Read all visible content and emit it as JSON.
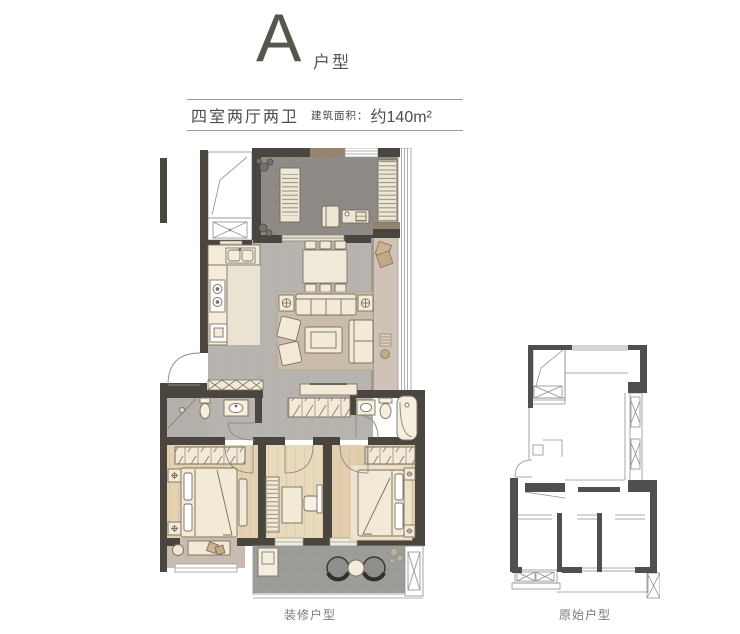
{
  "header": {
    "type_letter": "A",
    "type_suffix": "户型"
  },
  "spec": {
    "rooms": "四室两厅两卫",
    "area_label": "建筑面积：",
    "area_value": "约140m²"
  },
  "captions": {
    "furnished": "装修户型",
    "original": "原始户型"
  },
  "colors": {
    "title_gray": "#58554f",
    "label_gray": "#7a7a7a",
    "wall_dark": "#4a453f",
    "wall_brown_accent": "#94836f",
    "floor_main_gray": "#b7b4b0",
    "floor_dark_room": "#8e8b86",
    "floor_kitchen_cream": "#ebe3d1",
    "floor_wood": "#e4d2b3",
    "floor_lower_balcony": "#9c9c99",
    "floor_upper_balcony_pink": "#cfc2b6",
    "furniture_cream": "#f2e9d7",
    "rug_living": "#c9bcab",
    "outline_plan_thin": "#9a9a9a",
    "wall_original_plan": "#4f4f4f"
  }
}
